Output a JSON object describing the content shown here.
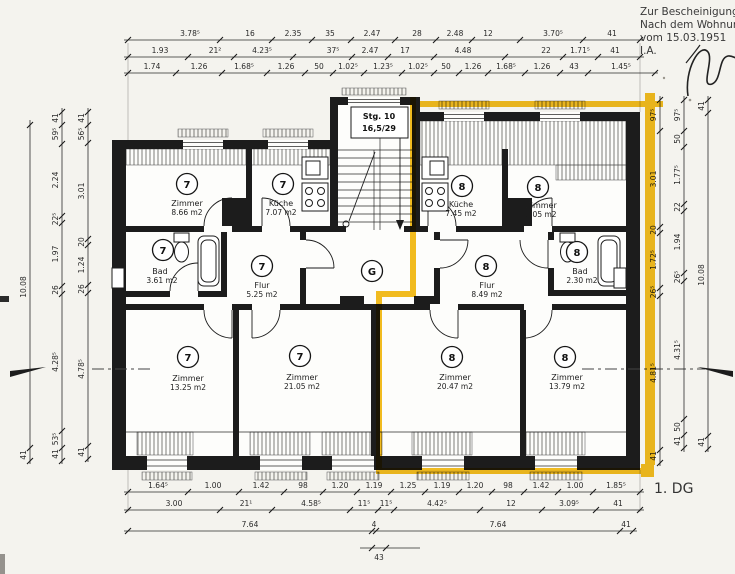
{
  "annotation": {
    "line1": "Zur Bescheinigung",
    "line2": "Nach dem Wohnun",
    "line3": "vom 15.03.1951",
    "line4": "I.A."
  },
  "floor_label": "1. DG",
  "stair": {
    "label1": "Stg. 10",
    "label2": "16,5/29"
  },
  "corridor_label": "G",
  "rooms": [
    {
      "unit": "7",
      "name": "Zimmer",
      "area": "8.66 m2"
    },
    {
      "unit": "7",
      "name": "Küche",
      "area": "7.07 m2"
    },
    {
      "unit": "7",
      "name": "Bad",
      "area": "3.61 m2"
    },
    {
      "unit": "7",
      "name": "Flur",
      "area": "5.25 m2"
    },
    {
      "unit": "7",
      "name": "Zimmer",
      "area": "13.25 m2"
    },
    {
      "unit": "7",
      "name": "Zimmer",
      "area": "21.05 m2"
    },
    {
      "unit": "8",
      "name": "Küche",
      "area": "7.45 m2"
    },
    {
      "unit": "8",
      "name": "Zimmer",
      "area": "9.05 m2"
    },
    {
      "unit": "8",
      "name": "Flur",
      "area": "8.49 m2"
    },
    {
      "unit": "8",
      "name": "Bad",
      "area": "2.30 m2"
    },
    {
      "unit": "8",
      "name": "Zimmer",
      "area": "20.47 m2"
    },
    {
      "unit": "8",
      "name": "Zimmer",
      "area": "13.79 m2"
    }
  ],
  "dimensions": {
    "top": {
      "row1": [
        "3.78⁵",
        "16",
        "2.35",
        "35",
        "2.47",
        "28",
        "2.48",
        "12",
        "3.70⁵",
        "41"
      ],
      "row2": [
        "1.93",
        "21²",
        "4.23⁵",
        "37⁵",
        "2.47",
        "17",
        "4.48",
        "22",
        "1.71⁵",
        "41"
      ],
      "row3": [
        "1.74",
        "1.26",
        "1.68⁵",
        "1.26",
        "50",
        "1.02⁵",
        "1.23⁵",
        "1.02⁵",
        "50",
        "1.26",
        "1.68⁵",
        "1.26",
        "43",
        "1.45⁵"
      ]
    },
    "bottom": {
      "row1": [
        "1.64⁵",
        "1.00",
        "1.42",
        "98",
        "1.20",
        "1.19",
        "1.25",
        "1.19",
        "1.20",
        "98",
        "1.42",
        "1.00",
        "1.85⁵"
      ],
      "row2": [
        "3.00",
        "21¹",
        "4.58⁵",
        "11⁵",
        "11⁵",
        "4.42⁵",
        "12",
        "3.09⁵",
        "41"
      ],
      "row3": [
        "7.64",
        "4",
        "7.64",
        "41"
      ],
      "row4": [
        "43"
      ]
    },
    "left": {
      "outer": [
        "10.08",
        "41"
      ],
      "middle": [
        "41",
        "59⁵",
        "2.24",
        "22⁵",
        "1.97",
        "26",
        "4.28⁵",
        "53⁵",
        "41"
      ],
      "inner": [
        "41",
        "56⁵",
        "3.01",
        "20",
        "1.24",
        "26",
        "4.78⁵",
        "41"
      ]
    },
    "right": {
      "inner": [
        "97⁵",
        "3.01",
        "20",
        "1.72⁵",
        "26⁵",
        "4.81⁵",
        "41"
      ],
      "middle": [
        "97⁵",
        "50",
        "1.77⁵",
        "22",
        "1.94",
        "26⁵",
        "4.31⁵",
        "50",
        "41"
      ],
      "outer": [
        "41",
        "10.08",
        "41"
      ]
    }
  },
  "colors": {
    "highlight": "#f2b400",
    "wall": "#1c1c1c",
    "paper": "#f4f3ee"
  }
}
